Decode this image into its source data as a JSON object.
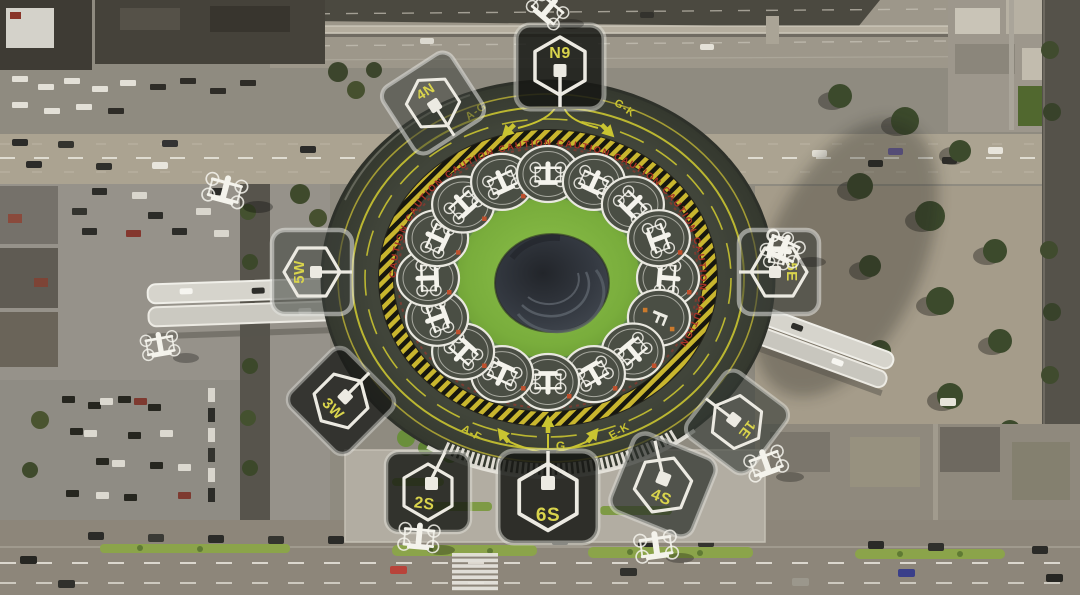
{
  "vertiport": {
    "gate_badges": [
      {
        "id": "n9",
        "label": "N9"
      },
      {
        "id": "4n",
        "label": "4N"
      },
      {
        "id": "5w",
        "label": "5W"
      },
      {
        "id": "5e",
        "label": "5E"
      },
      {
        "id": "3w",
        "label": "3W"
      },
      {
        "id": "1e",
        "label": "1E"
      },
      {
        "id": "2s",
        "label": "2S"
      },
      {
        "id": "6s",
        "label": "6S"
      },
      {
        "id": "4s",
        "label": "4S"
      }
    ],
    "approach_markings": {
      "top_left": "A-G",
      "top_right": "G-K",
      "bottom_left": "A-F",
      "bottom_center": "G",
      "bottom_right": "E-K"
    },
    "caution_word": "CAUTION",
    "caution_ring_text": "CAUTION         CAUTION         CAUTION         CAUTION         CAUTION         CAUTION         CAUTION         CAUTION         CAUTION",
    "pad_letter": "F"
  },
  "icons": {
    "drone": "drone-icon",
    "gate_hexagon": "hexagon-gate-icon",
    "pad_square": "pad-square-icon",
    "arrow": "taxi-arrow-icon"
  },
  "colors": {
    "marking_yellow": "#c9c431",
    "caution_red": "#a83228",
    "grass_green": "#79ad3c",
    "badge_label_yellow": "#d9d44c",
    "roof_dark": "#41453a",
    "pad_surface": "#4a4e44"
  }
}
